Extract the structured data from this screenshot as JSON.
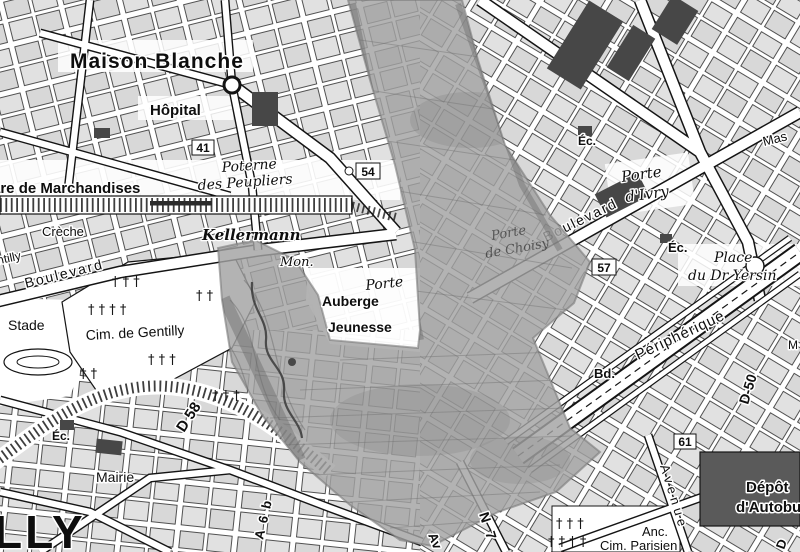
{
  "colors": {
    "bg": "#ffffff",
    "block_fill": "#d8d8d8",
    "ink": "#1a1a1a",
    "dark_building": "#474747",
    "depot_building": "#5a5a5a",
    "overlay_gray": "#a2a2a2",
    "overlay_line": "#6f6f6f",
    "river": "#3a3a3a"
  },
  "symbols": {
    "cross": "†",
    "crosses_2": "† †",
    "crosses_3": "† † †",
    "crosses_4": "† † † †"
  },
  "labels": {
    "maison_blanche": "Maison Blanche",
    "hopital": "Hôpital",
    "gare_marchandises": "are de Marchandises",
    "poterne_line1": "Poterne",
    "poterne_line2": "des Peupliers",
    "creche": "Crèche",
    "kellermann": "Kellermann",
    "kellermann_mon": "Mon.",
    "boulevard_left": "Boulevard",
    "gentilly_edge": "ntilly",
    "stade": "Stade",
    "cim_gentilly": "Cim. de Gentilly",
    "porte_italie_partial": "Porte",
    "auberge_line1": "Auberge",
    "auberge_line2": "Jeunesse",
    "porte_choisy_line1": "Porte",
    "porte_choisy_line2": "de Choisy",
    "boulevard_right": "Boulevard",
    "porte_ivry_line1": "Porte",
    "porte_ivry_line2": "d'Ivry",
    "ec_top_right": "Éc.",
    "massena_partial": "Mas",
    "ec_ivry": "Éc.",
    "place_line1": "Place",
    "place_line2": "du Dr Yersin",
    "peripherique": "Périphérique",
    "bd_abbrev": "Bd.",
    "m_partial": "M",
    "avenue_right": "Avenue",
    "depot_line1": "Dépôt",
    "depot_line2": "d'Autobus",
    "anc": "Anc.",
    "cim_parisien": "Cim. Parisien",
    "d_partial": "D",
    "ec_mairie": "Éc.",
    "mairie": "Mairie",
    "gentilly_big": "LLY",
    "av_partial": "Av"
  },
  "badges": {
    "b41": "41",
    "b54": "54",
    "b57": "57",
    "b61": "61"
  },
  "road_refs": {
    "d58": "D 58",
    "d50": "D-50",
    "a6b": "A 6 b",
    "n7": "N 7"
  }
}
